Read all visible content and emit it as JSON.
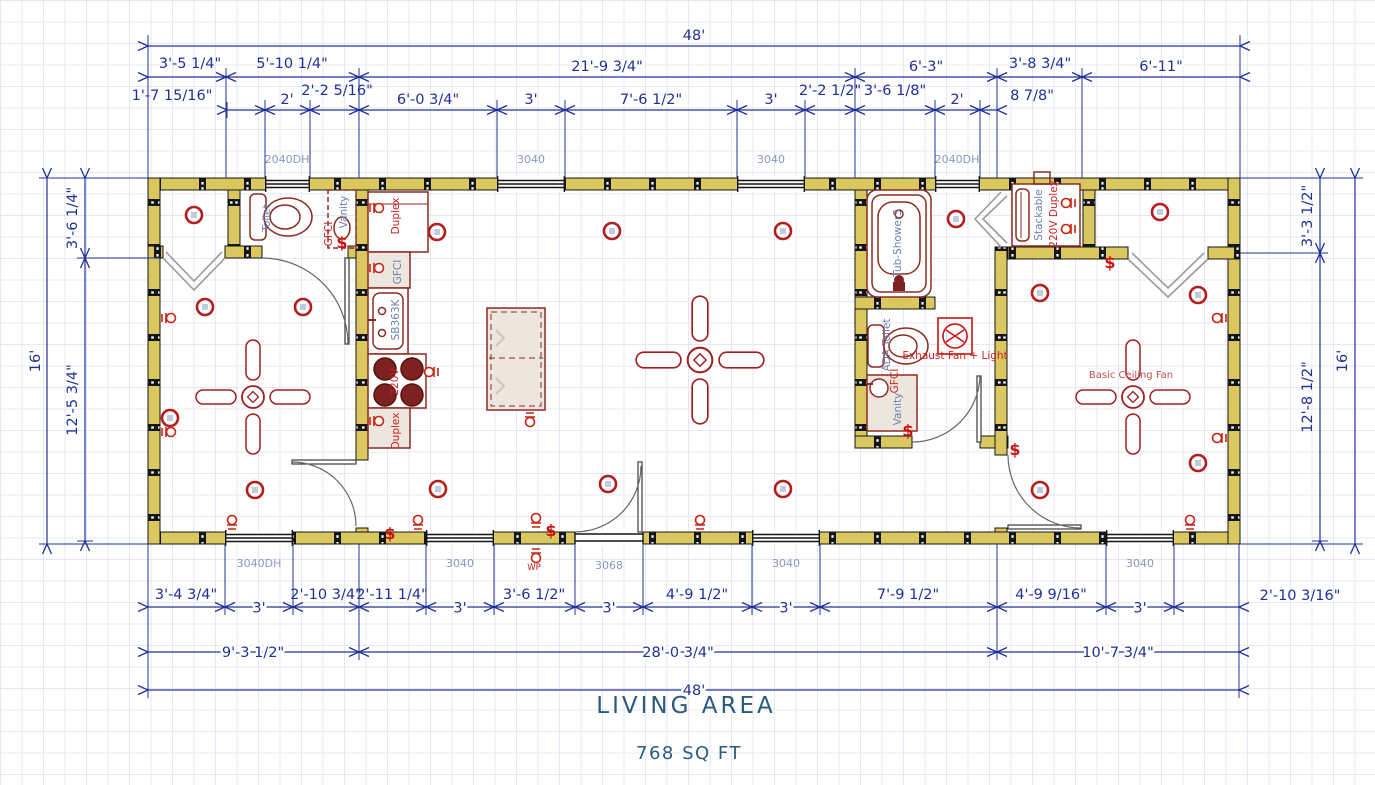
{
  "plan": {
    "title": "LIVING AREA",
    "area": "768 SQ FT"
  },
  "dimensions": {
    "overall_top": "48'",
    "overall_bottom": "48'",
    "top_row1": [
      "3'-5 1/4\"",
      "5'-10 1/4\"",
      "21'-9 3/4\"",
      "6'-3\"",
      "3'-8 3/4\"",
      "6'-11\""
    ],
    "top_row2": [
      "1'-7 15/16\"",
      "2'",
      "2'-2 5/16\"",
      "6'-0 3/4\"",
      "3'",
      "7'-6 1/2\"",
      "3'",
      "2'-2 1/2\"",
      "3'-6 1/8\"",
      "2'",
      "8 7/8\""
    ],
    "left_side": {
      "top": "3'-6 1/4\"",
      "bottom": "12'-5 3/4\"",
      "overall": "16'"
    },
    "right_side": {
      "top": "3'-3 1/2\"",
      "bottom": "12'-8 1/2\"",
      "overall": "16'"
    },
    "bottom_row1": [
      "3'-4 3/4\"",
      "3'",
      "2'-10 3/4\"",
      "2'-11 1/4\"",
      "3'",
      "3'-6 1/2\"",
      "3'",
      "4'-9 1/2\"",
      "3'",
      "7'-9 1/2\"",
      "4'-9 9/16\"",
      "3'",
      "2'-10 3/16\""
    ],
    "bottom_row2": [
      "9'-3 1/2\"",
      "28'-0 3/4\"",
      "10'-7 3/4\""
    ]
  },
  "window_labels": {
    "top": [
      "2040DH",
      "3040",
      "3040",
      "2040DH"
    ],
    "bottom": [
      "3040DH",
      "3040",
      "3068",
      "3040",
      "3040"
    ]
  },
  "fixtures": {
    "toilet": "Toilet",
    "vanity": "Vanity",
    "gfci": "GFCI",
    "duplex": "Duplex",
    "sink_base": "SB363K",
    "range_outlet": "220V",
    "tub": "Tub-Shower3",
    "ada_toilet": "ADA Toilet",
    "exhaust_fan": "Exhaust Fan + Light",
    "stackable": "Stackable",
    "stackable_outlet": "220V Duplex",
    "ceiling_fan": "Basic Ceiling Fan",
    "wp_outlet": "WP",
    "switch": "$"
  },
  "colors": {
    "dimension": "#20309a",
    "wall_fill": "#dbc75f",
    "fixture": "#8c2b21",
    "electrical": "#cc1111",
    "title": "#2a5a7d"
  }
}
